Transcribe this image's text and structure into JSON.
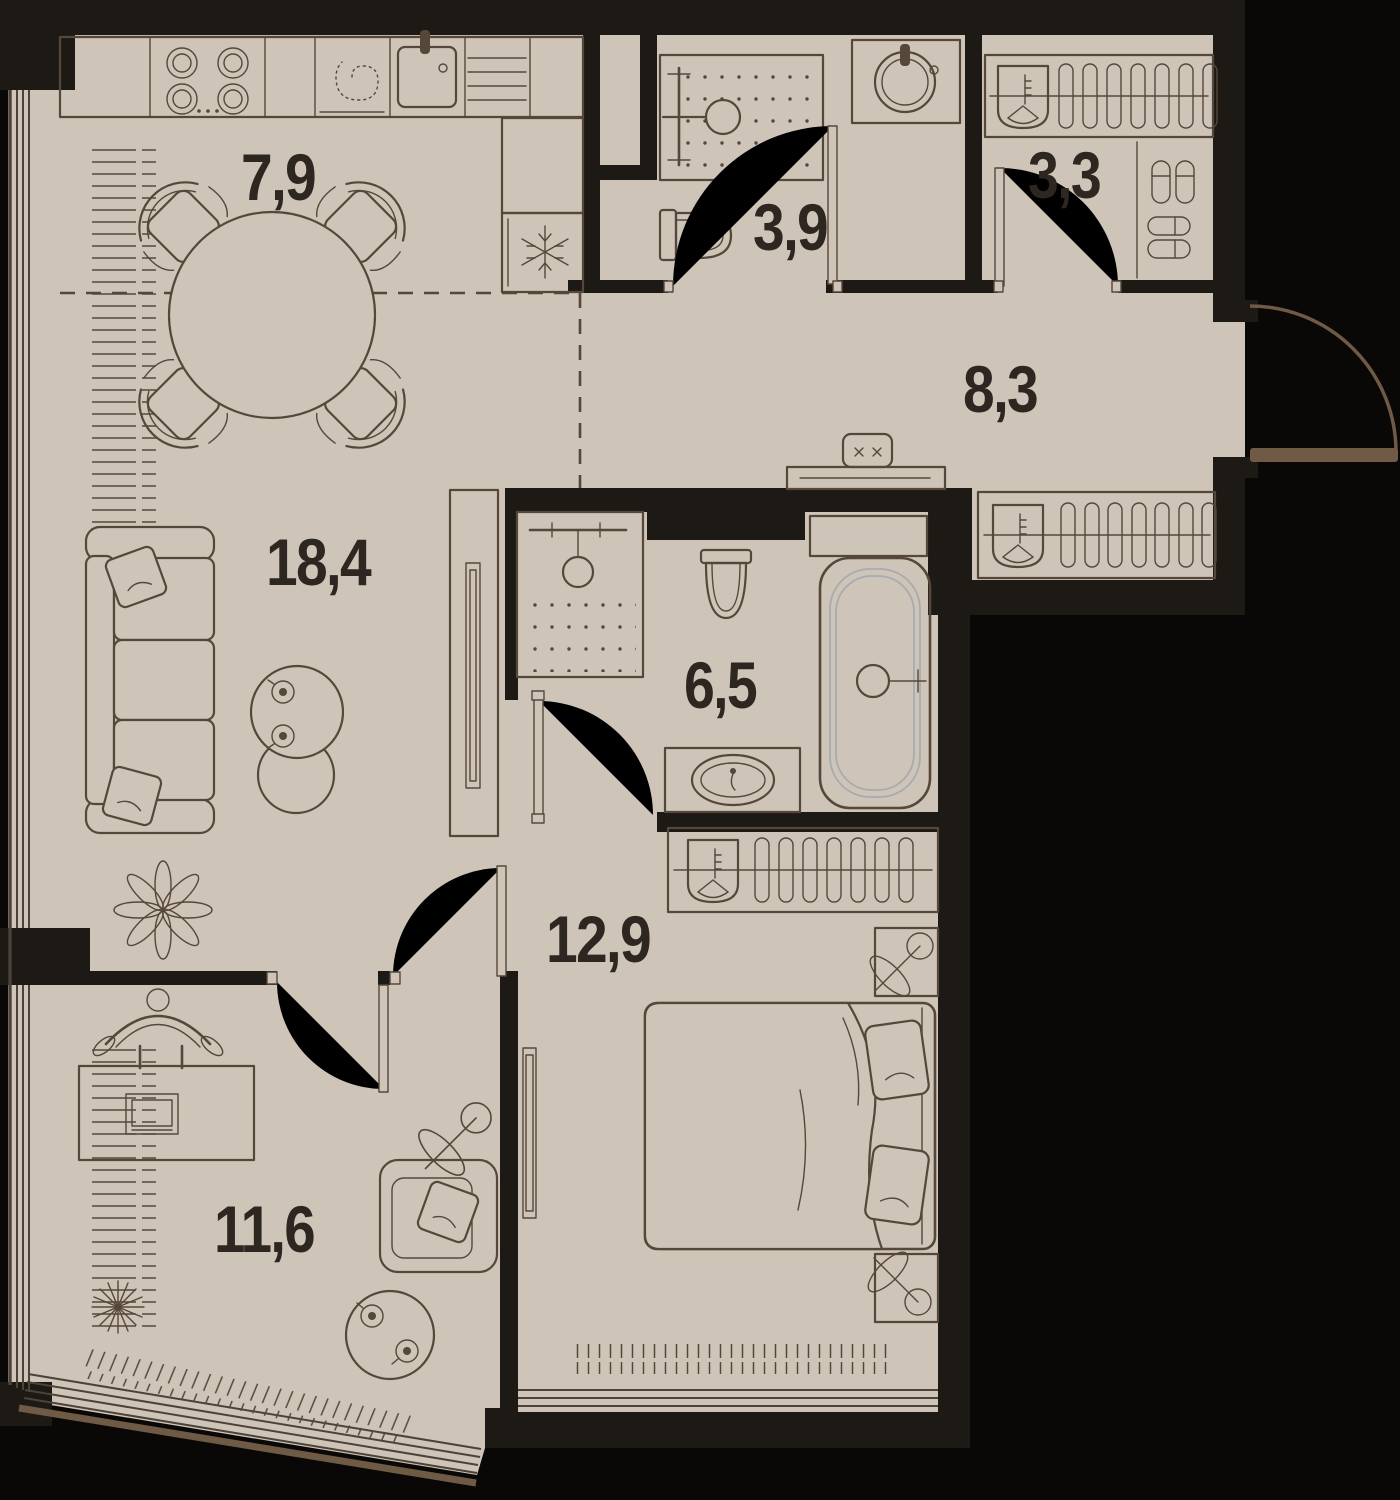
{
  "plan": {
    "rooms": [
      {
        "id": "kitchen-dining",
        "area": "7,9"
      },
      {
        "id": "bathroom-small",
        "area": "3,9"
      },
      {
        "id": "wardrobe-closet",
        "area": "3,3"
      },
      {
        "id": "hallway",
        "area": "8,3"
      },
      {
        "id": "living-room",
        "area": "18,4"
      },
      {
        "id": "bathroom-main",
        "area": "6,5"
      },
      {
        "id": "bedroom",
        "area": "12,9"
      },
      {
        "id": "study",
        "area": "11,6"
      }
    ],
    "colors": {
      "floor": "#cfc4b8",
      "wall": "#1d1915",
      "outside": "#0a0807",
      "line": "#55473a",
      "window": "#4b4238",
      "door": "#6f5a45",
      "text": "#2d2621",
      "tub": "#a7abb0"
    }
  }
}
